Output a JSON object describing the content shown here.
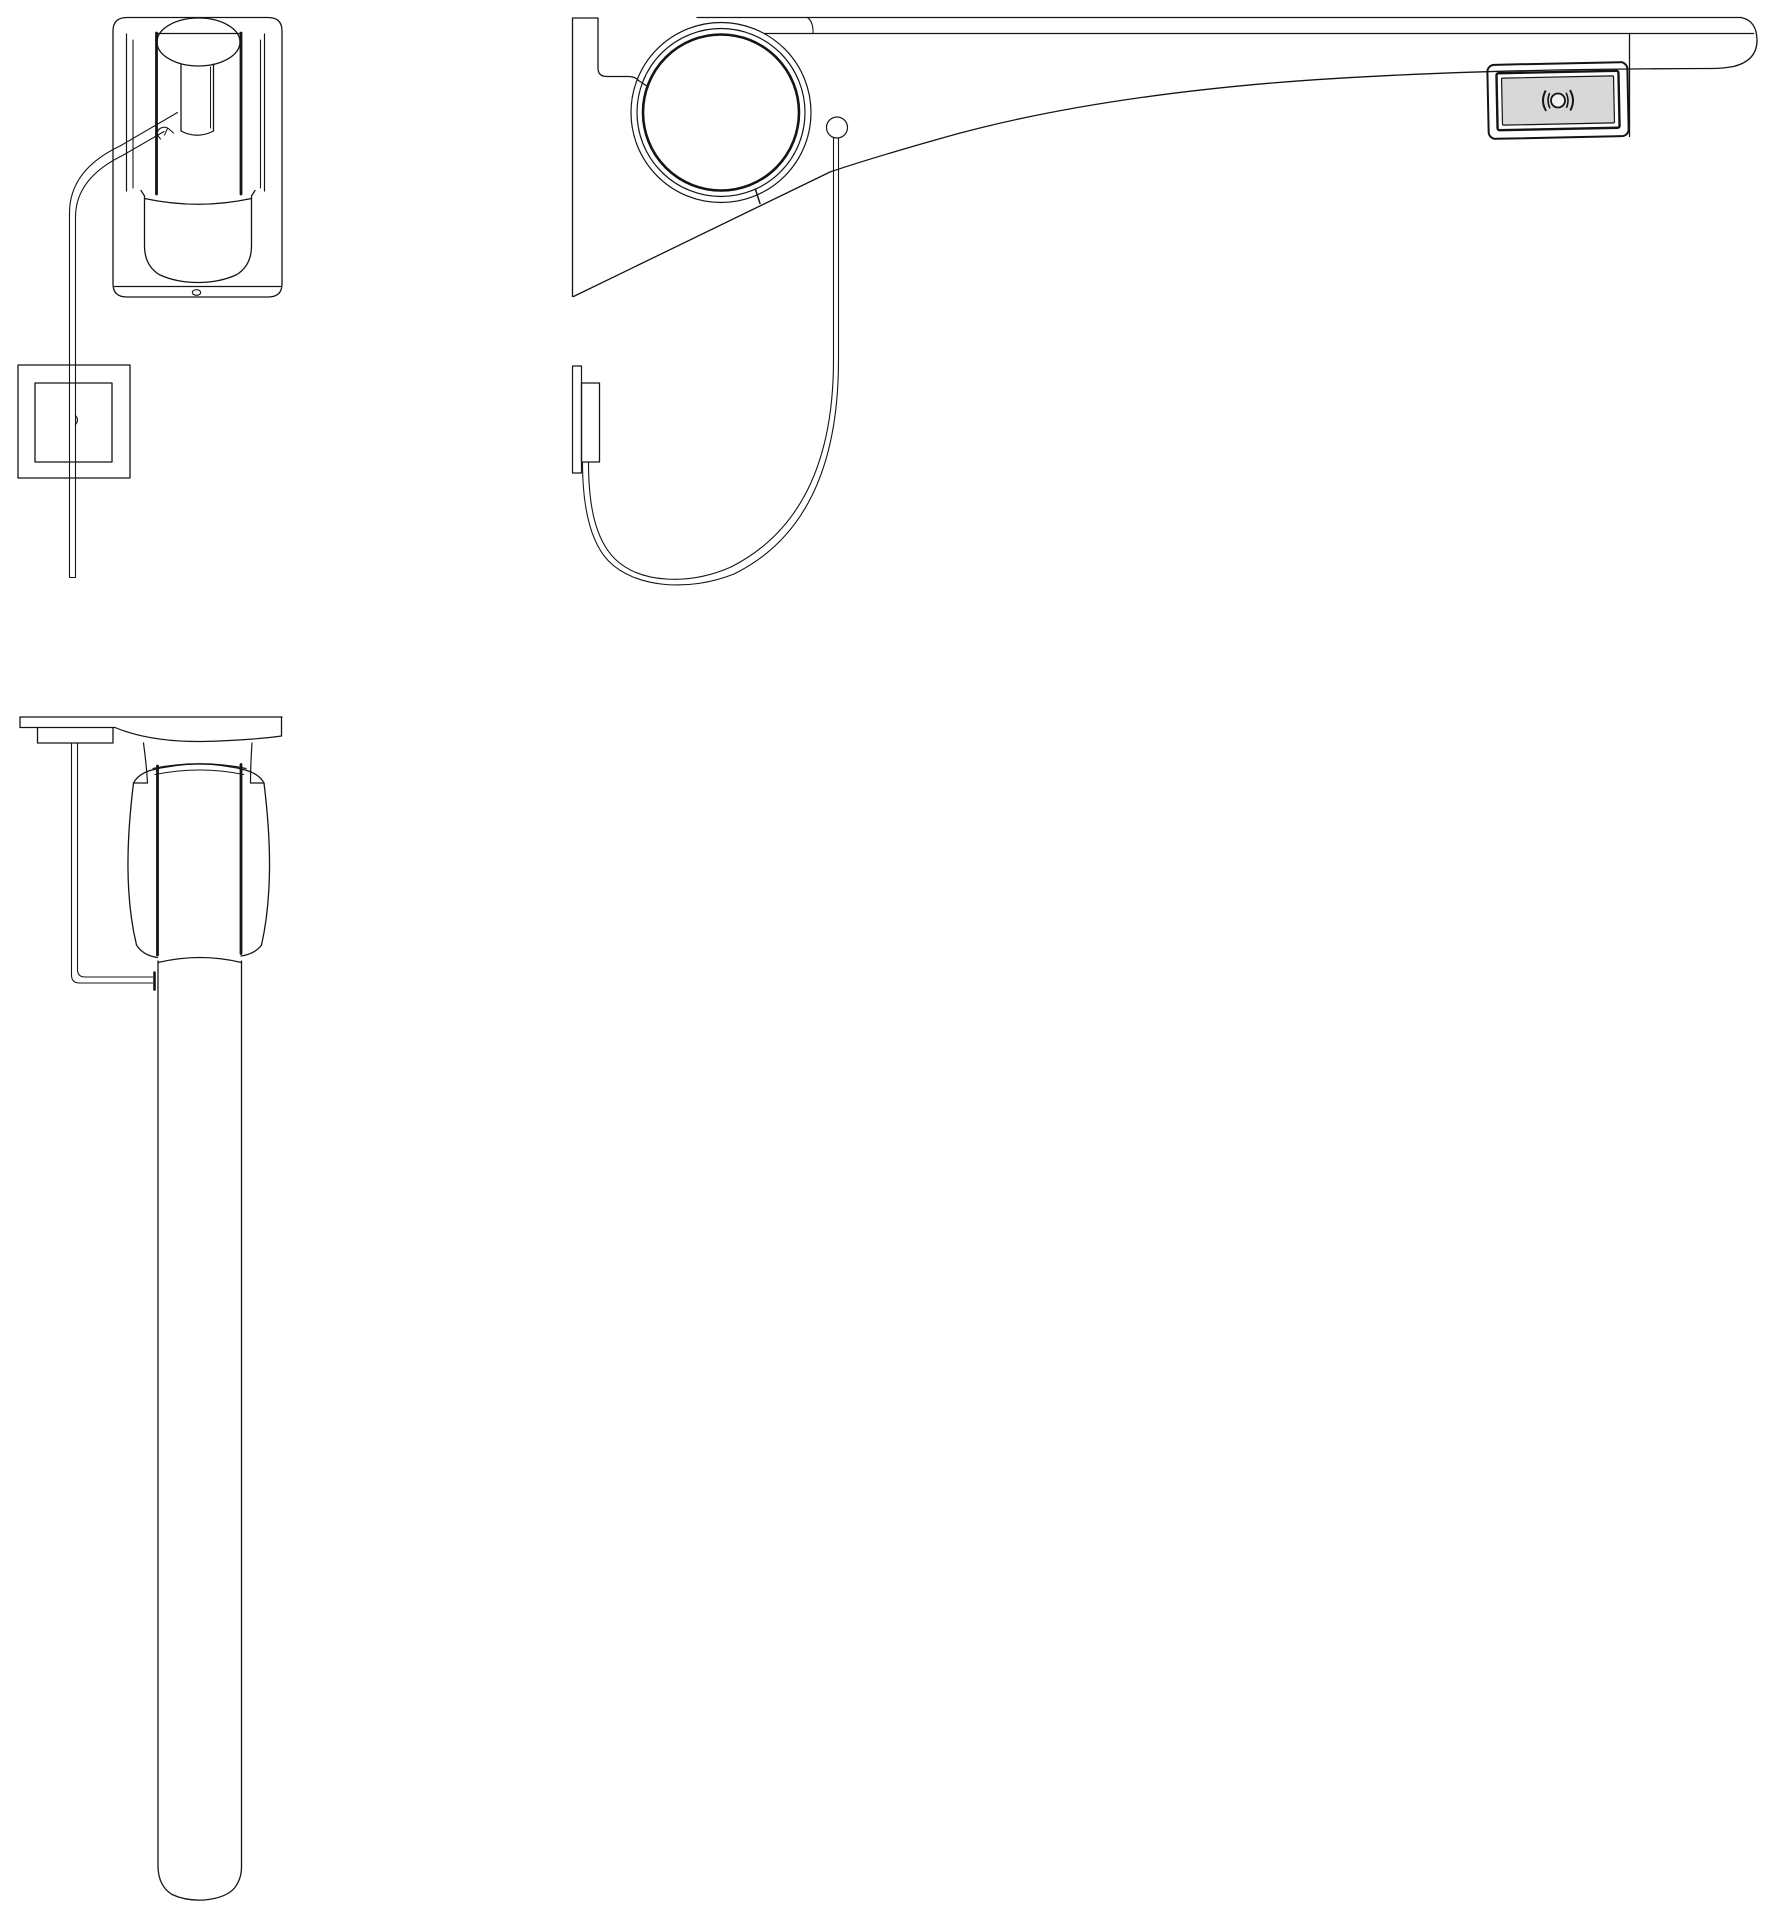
{
  "meta": {
    "canvas": {
      "width": 1772,
      "height": 1920
    },
    "background": "#ffffff",
    "line_color": "#141414"
  },
  "colors": {
    "switch_plate_fill": "#d8d8d8",
    "switch_symbol_fill": "#f2f2f2"
  },
  "drawing": {
    "description_views": [
      "front-view-arm-folded-with-pull-cord",
      "side-view-arm-horizontal-with-cord-loop-and-wireless-switch",
      "front-view-arm-lowered-long-tube"
    ],
    "views": [
      {
        "id": "view1",
        "name": "front-view-arm-folded",
        "elements": [
          {
            "t": "path",
            "n": "housing-outline",
            "d": "M113 31 Q113 17.5 127 17.5 L268 17.5 Q282 17.5 282 31 L282 284 Q282 297 268 297 L127 297 Q113 297 113 284 Z",
            "w": 1.3
          },
          {
            "t": "path",
            "n": "housing-wall-left-outer",
            "d": "M126.5 34 L126.5 191",
            "w": 1.2
          },
          {
            "t": "path",
            "n": "housing-wall-left-inner",
            "d": "M133 40 L133 188",
            "w": 1.1
          },
          {
            "t": "path",
            "n": "housing-wall-right-outer",
            "d": "M264.5 34 L264.5 191",
            "w": 1.2
          },
          {
            "t": "path",
            "n": "housing-wall-right-inner",
            "d": "M260.5 40 L260.5 188",
            "w": 1.1
          },
          {
            "t": "path",
            "n": "arm-edge-left-bold",
            "d": "M156.5 33 L156.5 194",
            "w": 2.8
          },
          {
            "t": "path",
            "n": "arm-edge-right-bold",
            "d": "M241 33 L241 194",
            "w": 2.8
          },
          {
            "t": "ellipse",
            "n": "pivot-dome",
            "cx": 198.5,
            "cy": 42,
            "rx": 41.5,
            "ry": 24,
            "w": 1.3
          },
          {
            "t": "path",
            "n": "pivot-dome-chord",
            "d": "M157 33.5 L240 33.5",
            "w": 1.3
          },
          {
            "t": "path",
            "n": "center-tube-left",
            "d": "M181 65 L181 131",
            "w": 1.3
          },
          {
            "t": "path",
            "n": "center-tube-right",
            "d": "M213.5 64 L213.5 131",
            "w": 1.3
          },
          {
            "t": "path",
            "n": "center-tube-right-inner",
            "d": "M210.5 67 L210.5 128",
            "w": 1
          },
          {
            "t": "path",
            "n": "center-tube-bottom",
            "d": "M181 131 Q197 139.5 213.5 131",
            "w": 1.2
          },
          {
            "t": "path",
            "n": "arm-cup-outline",
            "d": "M141 190.5 L144.5 196 L144.5 246 Q144.5 265 159 274.5 Q176 282.5 198 282.5 Q220 282.5 237 274.5 Q251.5 265 251.5 246 L251.5 196 L255 190.5",
            "w": 1.3
          },
          {
            "t": "path",
            "n": "arm-cup-top-arc",
            "d": "M144.5 198.5 Q198 210 251.5 198.5",
            "w": 1.2
          },
          {
            "t": "path",
            "n": "housing-bottom-line",
            "d": "M114.5 286.5 L280.5 286.5",
            "w": 1.2
          },
          {
            "t": "ellipse",
            "n": "housing-bottom-oval",
            "cx": 196.5,
            "cy": 292.5,
            "rx": 4.2,
            "ry": 2.8,
            "w": 1.1
          },
          {
            "t": "path",
            "n": "pull-cord-line-a",
            "d": "M177.5 112.5 L120 146 Q69.5 170 69.5 213 L69.5 577.5",
            "w": 1.1
          },
          {
            "t": "path",
            "n": "pull-cord-line-b",
            "d": "M164 131.5 L122.5 155.5 Q75.5 178.5 75.5 217 L75.5 577.5",
            "w": 1.1
          },
          {
            "t": "path",
            "n": "pull-cord-end",
            "d": "M69.5 577.5 L75.5 577.5",
            "w": 1.1
          },
          {
            "t": "path",
            "n": "cord-hook",
            "d": "M160.5 139 Q154.5 132.5 160 128.5 Q165.5 125.5 169.5 129.5 L173.5 133",
            "w": 1.1
          },
          {
            "t": "path",
            "n": "cord-hook-tick",
            "d": "M167.5 128.5 L164.5 135",
            "w": 1
          },
          {
            "t": "rect",
            "n": "wall-plate-outer",
            "x": 18,
            "y": 365,
            "w2": 112,
            "h": 113,
            "w": 1.3
          },
          {
            "t": "rect",
            "n": "wall-plate-inner",
            "x": 35,
            "y": 383,
            "w2": 77,
            "h": 79,
            "w": 1.3
          },
          {
            "t": "path",
            "n": "plate-cord-tick",
            "d": "M75.5 415.5 Q79.5 420 75.5 424.5",
            "w": 1.1
          }
        ]
      },
      {
        "id": "view2",
        "name": "side-view-arm-horizontal",
        "elements": [
          {
            "t": "path",
            "n": "wall-bracket-profile",
            "d": "M572.5 296.5 L572.5 18 L598 18 L598 68 Q598 76.5 607 76.5 L628 76.5 Q635.5 76.5 638.5 80.5 L646 85.5",
            "w": 1.3
          },
          {
            "t": "path",
            "n": "rail-top-line",
            "d": "M697 17.5 L1741 17.5",
            "w": 1.3
          },
          {
            "t": "path",
            "n": "rail-second-line",
            "d": "M764 33.5 L1753.5 33.5",
            "w": 1.3
          },
          {
            "t": "path",
            "n": "rail-shoulder-tick",
            "d": "M807.5 17.5 Q813.5 22 813 33.5",
            "w": 1.1
          },
          {
            "t": "path",
            "n": "rail-end-cap",
            "d": "M1741 17.5 Q1756.5 20.5 1757 39.5 Q1757.5 60.5 1733.5 66.5 Q1722.5 68.5 1711.5 68.5",
            "w": 1.3
          },
          {
            "t": "path",
            "n": "rail-underside-curve",
            "d": "M1711.5 68.5 Q1440 69 1272 83 Q1073 100 937 139.5 Q866.5 159.5 830 172 L573.5 296.5",
            "w": 1.3
          },
          {
            "t": "circle",
            "n": "pivot-circle-outer",
            "cx": 721,
            "cy": 112.5,
            "r": 90,
            "w": 1.2
          },
          {
            "t": "circle",
            "n": "pivot-circle-mid",
            "cx": 721,
            "cy": 112.5,
            "r": 84,
            "w": 1.2
          },
          {
            "t": "circle",
            "n": "pivot-circle-inner-bold",
            "cx": 721,
            "cy": 112.5,
            "r": 78,
            "w": 2.6
          },
          {
            "t": "path",
            "n": "pivot-seam-tick",
            "d": "M755.5 189.5 L760 203.5",
            "w": 1.5
          },
          {
            "t": "circle",
            "n": "cord-attachment-ring",
            "cx": 837,
            "cy": 127.5,
            "r": 10.5,
            "w": 1.2
          },
          {
            "t": "path",
            "n": "cord-loop-line-a",
            "d": "M833.5 138 L833.5 360 C833.5 468 796 534 731 567 C690 585 641 584 615 559 C595 539 588.5 505 588.5 462",
            "w": 1.1
          },
          {
            "t": "path",
            "n": "cord-loop-line-b",
            "d": "M838.5 138 L838.5 360 C838.5 476 799 542 734 574 C689 592 635 588 608.5 561 C589.5 541 582.5 505 582.5 462",
            "w": 1.1
          },
          {
            "t": "rect",
            "n": "wall-box-backplate",
            "x": 572.5,
            "y": 366,
            "w2": 9,
            "h": 107,
            "w": 1.2
          },
          {
            "t": "rect",
            "n": "wall-box-body",
            "x": 581.5,
            "y": 383,
            "w2": 18,
            "h": 79,
            "w": 1.3
          },
          {
            "t": "path",
            "n": "switch-mount-line",
            "d": "M1629.5 33.5 L1629.5 136.5",
            "w": 1.3
          },
          {
            "t": "rect",
            "n": "wireless-switch-outer-frame",
            "x": 1488,
            "y": 63.5,
            "w2": 140,
            "h": 74,
            "rx": 7,
            "w": 2,
            "rot": [
              -1.2,
              1558,
              100
            ]
          },
          {
            "t": "rect",
            "n": "wireless-switch-mid-frame",
            "x": 1497,
            "y": 72,
            "w2": 122,
            "h": 57,
            "rx": 2,
            "w": 2.4,
            "rot": [
              -1.2,
              1558,
              100
            ]
          },
          {
            "t": "rect",
            "n": "wireless-switch-plate",
            "x": 1502,
            "y": 77,
            "w2": 112,
            "h": 47,
            "rx": 1,
            "w": 1.2,
            "fillKey": "switch_plate_fill",
            "rot": [
              -1.2,
              1558,
              100
            ]
          },
          {
            "t": "circle",
            "n": "wireless-symbol-circle",
            "cx": 1558,
            "cy": 100.5,
            "r": 7,
            "w": 1.8,
            "fillKey": "switch_symbol_fill",
            "rot": [
              -1.2,
              1558,
              100
            ]
          },
          {
            "t": "path",
            "n": "wireless-symbol-wave-left-outer",
            "d": "M1545.5 91 Q1540.5 100.5 1545.5 110",
            "w": 2,
            "rot": [
              -1.2,
              1558,
              100
            ]
          },
          {
            "t": "path",
            "n": "wireless-symbol-wave-left-inner",
            "d": "M1549.5 93.5 Q1546.5 100.5 1549.5 107.5",
            "w": 1.6,
            "rot": [
              -1.2,
              1558,
              100
            ]
          },
          {
            "t": "path",
            "n": "wireless-symbol-wave-right-outer",
            "d": "M1570.5 91 Q1575.5 100.5 1570.5 110",
            "w": 2,
            "rot": [
              -1.2,
              1558,
              100
            ]
          },
          {
            "t": "path",
            "n": "wireless-symbol-wave-right-inner",
            "d": "M1566.5 93.5 Q1569.5 100.5 1566.5 107.5",
            "w": 1.6,
            "rot": [
              -1.2,
              1558,
              100
            ]
          }
        ]
      },
      {
        "id": "view3",
        "name": "front-view-arm-lowered",
        "elements": [
          {
            "t": "path",
            "n": "top-plate-top-line",
            "d": "M20 717 L282 717",
            "w": 1.3
          },
          {
            "t": "path",
            "n": "top-plate-left-edge",
            "d": "M20 717 L20 727.5 L115 727.5",
            "w": 1.3
          },
          {
            "t": "path",
            "n": "top-plate-subblock",
            "d": "M37.5 727.5 L37.5 743 L113 743 L113 727.5",
            "w": 1.3
          },
          {
            "t": "path",
            "n": "top-plate-underside-arc",
            "d": "M115 727.5 Q150 742 202 741.5 Q248 740.5 281.5 736",
            "w": 1.2
          },
          {
            "t": "path",
            "n": "top-plate-right-edge",
            "d": "M281.5 717 L281.5 736",
            "w": 1.3
          },
          {
            "t": "path",
            "n": "neck-left",
            "d": "M143.5 743 Q146.5 765 147.5 783",
            "w": 1.2
          },
          {
            "t": "path",
            "n": "neck-right",
            "d": "M252 743 Q250.5 765 250.5 783",
            "w": 1.2
          },
          {
            "t": "path",
            "n": "neck-left-step",
            "d": "M147.5 783 L133.5 783",
            "w": 1.2
          },
          {
            "t": "path",
            "n": "neck-right-step",
            "d": "M250.5 783 L264 783",
            "w": 1.2
          },
          {
            "t": "path",
            "n": "knob-top-outline",
            "d": "M133.5 783 Q138 774.5 150 770.5 Q200 757.5 247 770.5 Q259.5 774.5 264 783",
            "w": 1.3
          },
          {
            "t": "path",
            "n": "knob-left-side",
            "d": "M133.5 783 Q127.5 832 128 870 Q128.5 912 136.5 945",
            "w": 1.3
          },
          {
            "t": "path",
            "n": "knob-right-side",
            "d": "M264 783 Q270 832 269.5 870 Q269 912 261.5 945",
            "w": 1.3
          },
          {
            "t": "path",
            "n": "knob-shoulder-arc-1",
            "d": "M153 768.5 Q200 759 246 768.5",
            "w": 1.2
          },
          {
            "t": "path",
            "n": "knob-shoulder-arc-2",
            "d": "M155 774.5 Q200 765.5 243.5 774.5",
            "w": 1.1
          },
          {
            "t": "path",
            "n": "knob-edge-left-bold",
            "d": "M157.5 766 L157.5 955",
            "w": 2.8
          },
          {
            "t": "path",
            "n": "knob-edge-right-bold",
            "d": "M241 764.5 L241 953.5",
            "w": 2.8
          },
          {
            "t": "path",
            "n": "knob-bottom-left",
            "d": "M136.5 945 Q143 955.5 157.5 957.5",
            "w": 1.2
          },
          {
            "t": "path",
            "n": "knob-bottom-right",
            "d": "M261.5 945 Q255 954 241 956",
            "w": 1.2
          },
          {
            "t": "path",
            "n": "tube-shoulder-arc",
            "d": "M158 962.5 Q200 952.5 241.5 962.5",
            "w": 1.2
          },
          {
            "t": "path",
            "n": "tube-left-edge",
            "d": "M158 961 L158 1867",
            "w": 1.3
          },
          {
            "t": "path",
            "n": "tube-right-edge",
            "d": "M241.5 961 L241.5 1867",
            "w": 1.3
          },
          {
            "t": "path",
            "n": "tube-bottom-cap",
            "d": "M158 1867 Q158.5 1886 172 1894.5 Q186 1901 204 1900 Q226 1898 234.5 1888 Q241.5 1879 241.5 1867",
            "w": 1.3
          },
          {
            "t": "path",
            "n": "trigger-rod-line-a",
            "d": "M71.5 743 L71.5 975 Q71.5 983 79.5 983 L152.5 983",
            "w": 1.1
          },
          {
            "t": "path",
            "n": "trigger-rod-line-b",
            "d": "M77.5 743 L77.5 969.5 Q77.5 977 85 977 L152.5 977",
            "w": 1.1
          },
          {
            "t": "path",
            "n": "trigger-rod-end-nub",
            "d": "M154.5 972.5 L154.5 989.5",
            "w": 2.6
          }
        ]
      }
    ]
  }
}
